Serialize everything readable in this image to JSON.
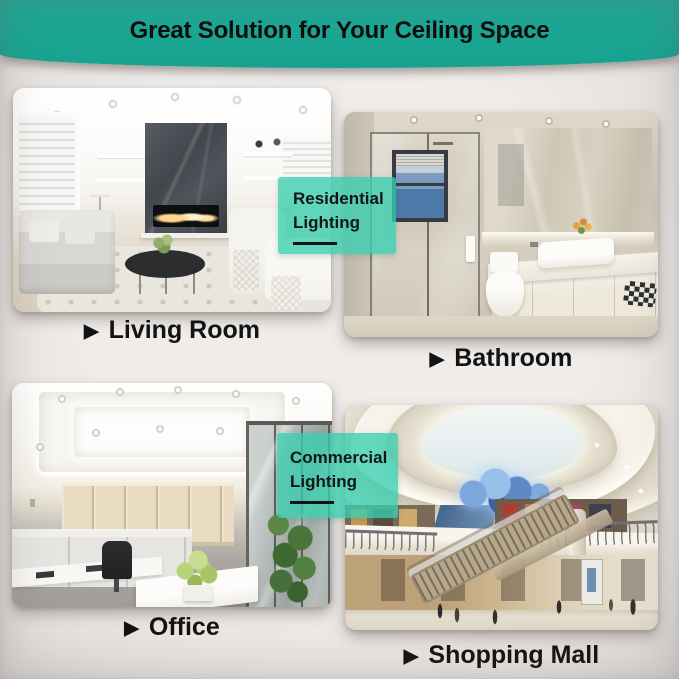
{
  "header": {
    "title": "Great Solution for Your Ceiling Space"
  },
  "badges": {
    "residential": {
      "line1": "Residential",
      "line2": "Lighting"
    },
    "commercial": {
      "line1": "Commercial",
      "line2": "Lighting"
    }
  },
  "captions": [
    {
      "arrow": "▶",
      "label": "Living Room"
    },
    {
      "arrow": "▶",
      "label": "Bathroom"
    },
    {
      "arrow": "▶",
      "label": "Office"
    },
    {
      "arrow": "▶",
      "label": "Shopping Mall"
    }
  ],
  "colors": {
    "banner_teal": "#1AA897",
    "badge_mint": "rgba(56,206,176,0.78)",
    "background": "#EAE6E3",
    "text_black": "#121212"
  }
}
